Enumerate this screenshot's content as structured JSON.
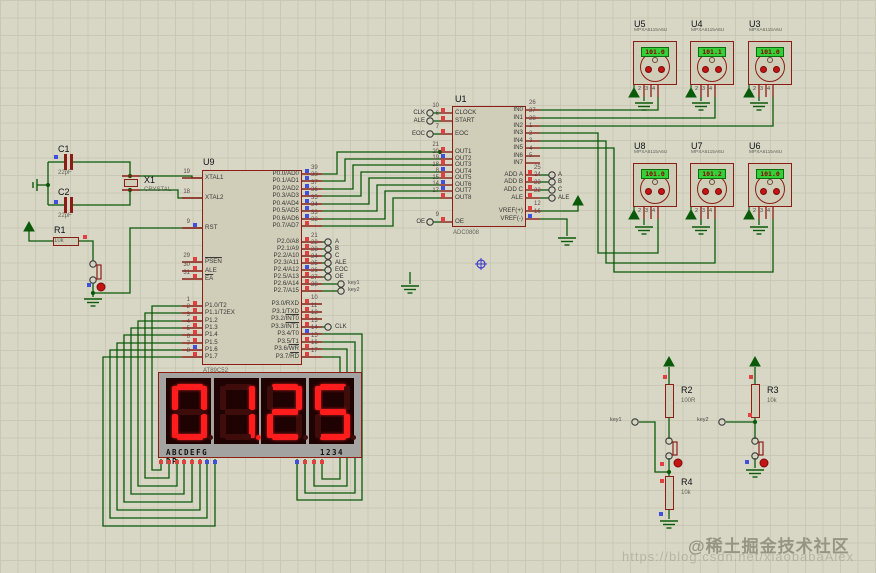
{
  "watermark": {
    "community": "@稀土掘金技术社区",
    "url": "https://blog.csdn.net/xiaobabaAlex"
  },
  "colors": {
    "wire": "#0a5a0a",
    "component_outline": "#8b1d15",
    "component_fill": "#d0ceb8",
    "segment_lit": "#ff1c1c",
    "segment_unlit": "#3f0c0c",
    "lcd_bg": "#35cf39",
    "lcd_text": "#8b0000",
    "state_high": "#e04040",
    "state_low": "#4050dd"
  },
  "mcu": {
    "ref": "U9",
    "part": "AT89C52",
    "left_pins": [
      {
        "num": "19",
        "name": "XTAL1"
      },
      {
        "num": "18",
        "name": "XTAL2"
      },
      {
        "num": "9",
        "name": "RST",
        "sq": "b"
      },
      {
        "num": "29",
        "name": "PSEN",
        "bar": "PSEN",
        "sq": "r"
      },
      {
        "num": "30",
        "name": "ALE",
        "sq": "r"
      },
      {
        "num": "31",
        "name": "EA",
        "bar": "EA",
        "sq": "r"
      },
      {
        "num": "1",
        "name": "P1.0/T2",
        "sq": "r"
      },
      {
        "num": "2",
        "name": "P1.1/T2EX",
        "sq": "r"
      },
      {
        "num": "3",
        "name": "P1.2",
        "sq": "r"
      },
      {
        "num": "4",
        "name": "P1.3",
        "sq": "r"
      },
      {
        "num": "5",
        "name": "P1.4",
        "sq": "r"
      },
      {
        "num": "6",
        "name": "P1.5",
        "sq": "r"
      },
      {
        "num": "7",
        "name": "P1.6",
        "sq": "b"
      },
      {
        "num": "8",
        "name": "P1.7",
        "sq": "r"
      }
    ],
    "right_pins": [
      {
        "num": "39",
        "name": "P0.0/AD0",
        "sq": "b"
      },
      {
        "num": "38",
        "name": "P0.1/AD1",
        "sq": "b"
      },
      {
        "num": "37",
        "name": "P0.2/AD2",
        "sq": "b"
      },
      {
        "num": "36",
        "name": "P0.3/AD3",
        "sq": "b"
      },
      {
        "num": "35",
        "name": "P0.4/AD4",
        "sq": "b"
      },
      {
        "num": "34",
        "name": "P0.5/AD5",
        "sq": "b"
      },
      {
        "num": "33",
        "name": "P0.6/AD6",
        "sq": "b"
      },
      {
        "num": "32",
        "name": "P0.7/AD7",
        "sq": "r"
      },
      {
        "num": "21",
        "name": "P2.0/A8",
        "sq": "r",
        "term": "A"
      },
      {
        "num": "22",
        "name": "P2.1/A9",
        "sq": "r",
        "term": "B"
      },
      {
        "num": "23",
        "name": "P2.2/A10",
        "sq": "r",
        "term": "C"
      },
      {
        "num": "24",
        "name": "P2.3/A11",
        "sq": "r",
        "term": "ALE"
      },
      {
        "num": "25",
        "name": "P2.4/A12",
        "sq": "b",
        "term": "EOC"
      },
      {
        "num": "26",
        "name": "P2.5/A13",
        "sq": "r",
        "term": "OE"
      },
      {
        "num": "27",
        "name": "P2.6/A14",
        "sq": "r",
        "term": "key1"
      },
      {
        "num": "28",
        "name": "P2.7/A15",
        "sq": "r",
        "term": "key2"
      },
      {
        "num": "10",
        "name": "P3.0/RXD",
        "sq": "r"
      },
      {
        "num": "11",
        "name": "P3.1/TXD",
        "sq": "r"
      },
      {
        "num": "12",
        "name": "P3.2/INT0",
        "bar": "INT0",
        "sq": "r"
      },
      {
        "num": "13",
        "name": "P3.3/INT1",
        "bar": "INT1",
        "sq": "r",
        "term": "CLK"
      },
      {
        "num": "14",
        "name": "P3.4/T0",
        "sq": "b"
      },
      {
        "num": "15",
        "name": "P3.5/T1",
        "sq": "r"
      },
      {
        "num": "16",
        "name": "P3.6/WR",
        "bar": "WR",
        "sq": "r"
      },
      {
        "num": "17",
        "name": "P3.7/RD",
        "bar": "RD",
        "sq": "r"
      }
    ]
  },
  "adc": {
    "ref": "U1",
    "part": "ADC0808",
    "left_pins": [
      {
        "num": "10",
        "name": "CLOCK",
        "sq": "r",
        "term": "CLK"
      },
      {
        "num": "6",
        "name": "START",
        "sq": "r",
        "term": "ALE"
      },
      {
        "num": "7",
        "name": "EOC",
        "sq": "r",
        "term": "EOC"
      },
      {
        "num": "21",
        "name": "OUT1",
        "sq": "r"
      },
      {
        "num": "20",
        "name": "OUT2",
        "sq": "b"
      },
      {
        "num": "19",
        "name": "OUT3",
        "sq": "r"
      },
      {
        "num": "18",
        "name": "OUT4",
        "sq": "b"
      },
      {
        "num": "8",
        "name": "OUT5",
        "sq": "r"
      },
      {
        "num": "15",
        "name": "OUT6",
        "sq": "b"
      },
      {
        "num": "14",
        "name": "OUT7",
        "sq": "b"
      },
      {
        "num": "17",
        "name": "OUT8",
        "sq": "r"
      },
      {
        "num": "9",
        "name": "OE",
        "sq": "r",
        "term": "OE"
      }
    ],
    "right_pins": [
      {
        "num": "26",
        "name": "IN0"
      },
      {
        "num": "27",
        "name": "IN1"
      },
      {
        "num": "28",
        "name": "IN2"
      },
      {
        "num": "1",
        "name": "IN3"
      },
      {
        "num": "2",
        "name": "IN4"
      },
      {
        "num": "3",
        "name": "IN5"
      },
      {
        "num": "4",
        "name": "IN6"
      },
      {
        "num": "5",
        "name": "IN7"
      },
      {
        "num": "25",
        "name": "ADD A",
        "sq": "r",
        "term": "A"
      },
      {
        "num": "24",
        "name": "ADD B",
        "sq": "r",
        "term": "B"
      },
      {
        "num": "23",
        "name": "ADD C",
        "sq": "r",
        "term": "C"
      },
      {
        "num": "22",
        "name": "ALE",
        "sq": "r",
        "term": "ALE"
      },
      {
        "num": "12",
        "name": "VREF(+)",
        "sq": "r"
      },
      {
        "num": "16",
        "name": "VREF(-)",
        "sq": "b"
      }
    ]
  },
  "sensors": [
    {
      "ref": "U5",
      "part": "MPXA6115A6U",
      "value": "101.0"
    },
    {
      "ref": "U4",
      "part": "MPXA6115A6U",
      "value": "101.1"
    },
    {
      "ref": "U3",
      "part": "MPXA6115A6U",
      "value": "101.0"
    },
    {
      "ref": "U8",
      "part": "MPXA6115A6U",
      "value": "101.0"
    },
    {
      "ref": "U7",
      "part": "MPXA6115A6U",
      "value": "101.2"
    },
    {
      "ref": "U6",
      "part": "MPXA6115A6U",
      "value": "101.0"
    }
  ],
  "sensor_pin_labels": [
    "2",
    "3",
    "4"
  ],
  "display": {
    "reading": "01.25",
    "digits": [
      "0",
      "1",
      "2",
      "5"
    ],
    "dp_index": 1,
    "segment_label": "ABCDEFG DP",
    "digit_label": "1234"
  },
  "passives": {
    "c1": {
      "ref": "C1",
      "value": "22pF"
    },
    "c2": {
      "ref": "C2",
      "value": "22pF"
    },
    "x1": {
      "ref": "X1",
      "value": "CRYSTAL"
    },
    "r1": {
      "ref": "R1",
      "value": "10k"
    },
    "r2": {
      "ref": "R2",
      "value": "100R"
    },
    "r3": {
      "ref": "R3",
      "value": "10k"
    },
    "r4": {
      "ref": "R4",
      "value": "10k"
    }
  },
  "terminals": {
    "key1": "key1",
    "key2": "key2"
  }
}
